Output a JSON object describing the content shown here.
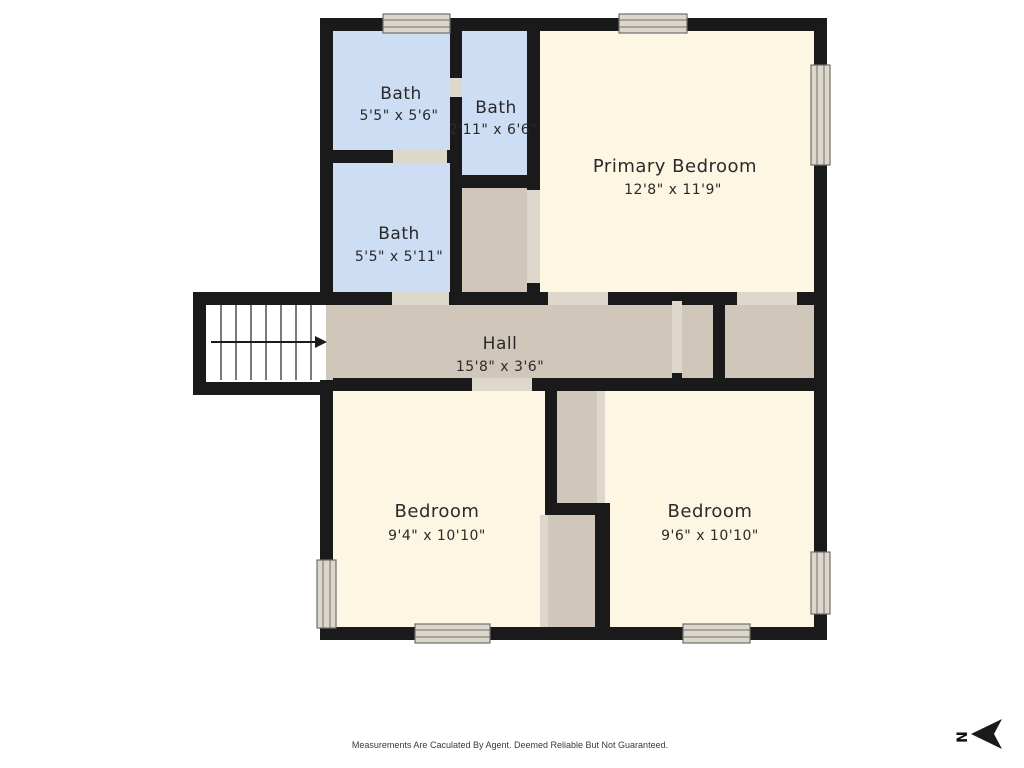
{
  "plan": {
    "rooms": [
      {
        "id": "bath-1",
        "name": "Bath",
        "dims": "5'5\" x 5'6\""
      },
      {
        "id": "bath-2",
        "name": "Bath",
        "dims": "2'11\" x 6'6\""
      },
      {
        "id": "bath-3",
        "name": "Bath",
        "dims": "5'5\" x 5'11\""
      },
      {
        "id": "primary-bedroom",
        "name": "Primary Bedroom",
        "dims": "12'8\" x 11'9\""
      },
      {
        "id": "hall",
        "name": "Hall",
        "dims": "15'8\" x 3'6\""
      },
      {
        "id": "bedroom-left",
        "name": "Bedroom",
        "dims": "9'4\" x 10'10\""
      },
      {
        "id": "bedroom-right",
        "name": "Bedroom",
        "dims": "9'6\" x 10'10\""
      }
    ],
    "compass": {
      "letter": "N"
    },
    "footer": "Measurements Are Caculated By Agent. Deemed Reliable But Not Guaranteed.",
    "colors": {
      "wall": "#1a1a1a",
      "bath": "#cdddf4",
      "cream": "#fdf6e3",
      "tan": "#d0c7ba",
      "door": "#ded7cb",
      "window": "#ddd6ca",
      "winframe": "#6e6e6e"
    }
  }
}
